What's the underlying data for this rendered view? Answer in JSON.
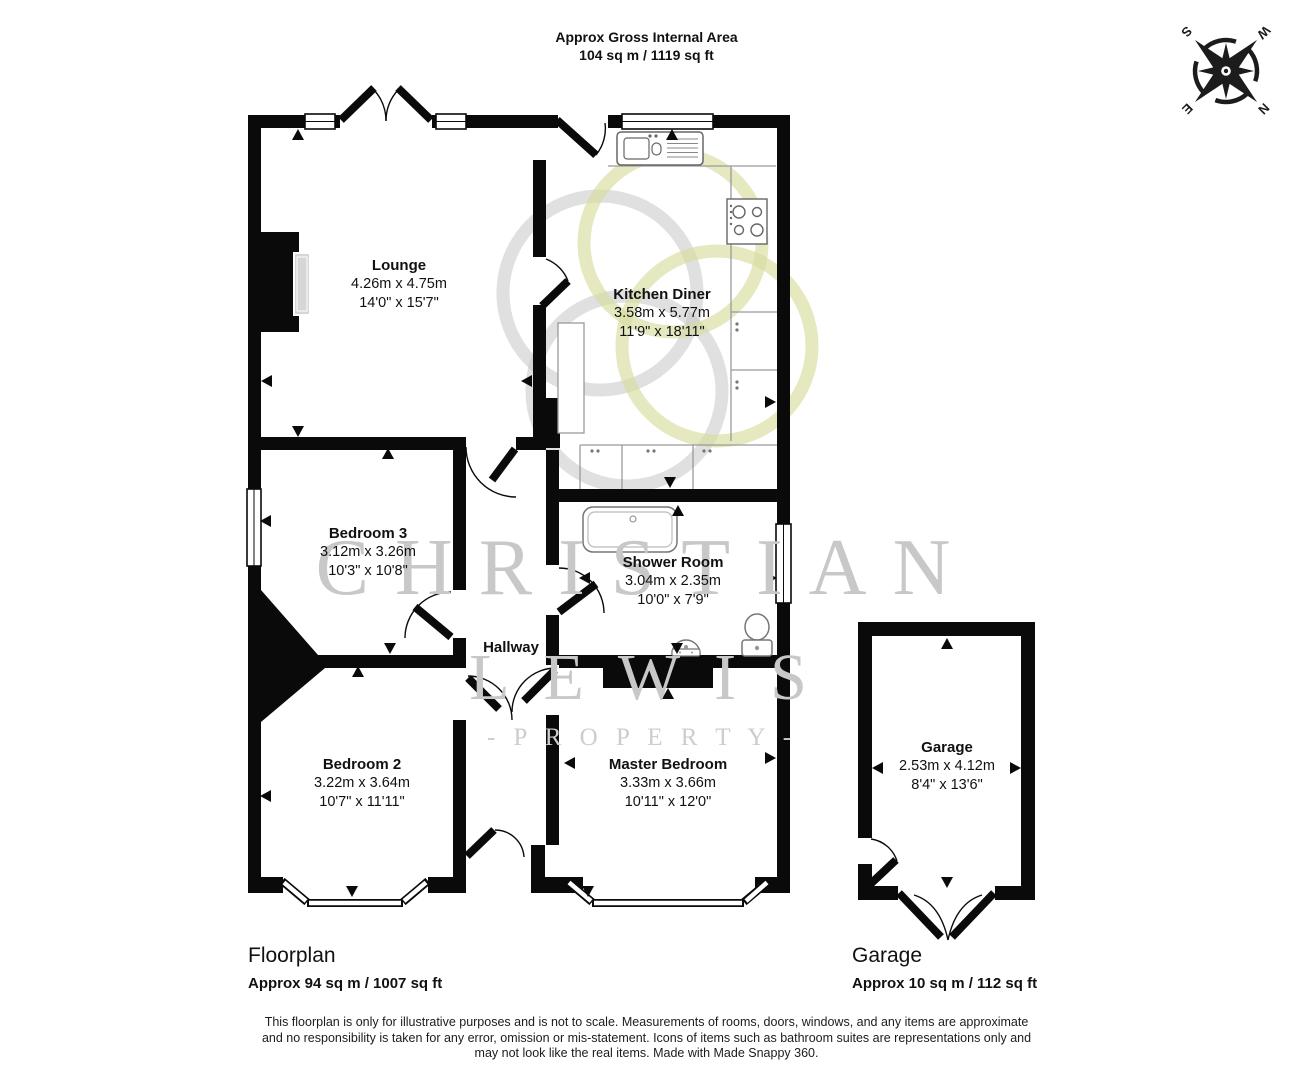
{
  "header": {
    "area_title": "Approx Gross Internal Area",
    "area_value": "104 sq m / 1119 sq ft"
  },
  "compass": {
    "n": "N",
    "e": "E",
    "s": "S",
    "w": "W"
  },
  "watermark": {
    "line1": "CHRISTIAN",
    "line2": "LEWIS",
    "line3": "- P R O P E R T Y -"
  },
  "rooms": {
    "lounge": {
      "name": "Lounge",
      "metric": "4.26m x 4.75m",
      "imperial": "14'0\" x 15'7\""
    },
    "kitchen": {
      "name": "Kitchen Diner",
      "metric": "3.58m x 5.77m",
      "imperial": "11'9\" x 18'11\""
    },
    "bedroom3": {
      "name": "Bedroom 3",
      "metric": "3.12m x 3.26m",
      "imperial": "10'3\" x 10'8\""
    },
    "shower": {
      "name": "Shower Room",
      "metric": "3.04m x 2.35m",
      "imperial": "10'0\" x 7'9\""
    },
    "hallway": {
      "name": "Hallway"
    },
    "bedroom2": {
      "name": "Bedroom 2",
      "metric": "3.22m x 3.64m",
      "imperial": "10'7\" x 11'11\""
    },
    "master": {
      "name": "Master Bedroom",
      "metric": "3.33m x 3.66m",
      "imperial": "10'11\" x 12'0\""
    },
    "garage": {
      "name": "Garage",
      "metric": "2.53m x 4.12m",
      "imperial": "8'4\" x 13'6\""
    }
  },
  "footer": {
    "floorplan_label": "Floorplan",
    "floorplan_area": "Approx 94 sq m / 1007 sq ft",
    "garage_label": "Garage",
    "garage_area": "Approx 10 sq m / 112 sq ft"
  },
  "disclaimer": {
    "line1": "This floorplan is only for illustrative purposes and is not to scale. Measurements of rooms, doors, windows, and any items are approximate",
    "line2": "and no responsibility is taken for any error, omission or mis-statement. Icons of items such as bathroom suites are representations only and",
    "line3": "may not look like the real items. Made with Made Snappy 360."
  },
  "colors": {
    "wall": "#0a0a0a",
    "watermark_gray": "#c8c8c8",
    "watermark_olive": "#d9db9c"
  }
}
